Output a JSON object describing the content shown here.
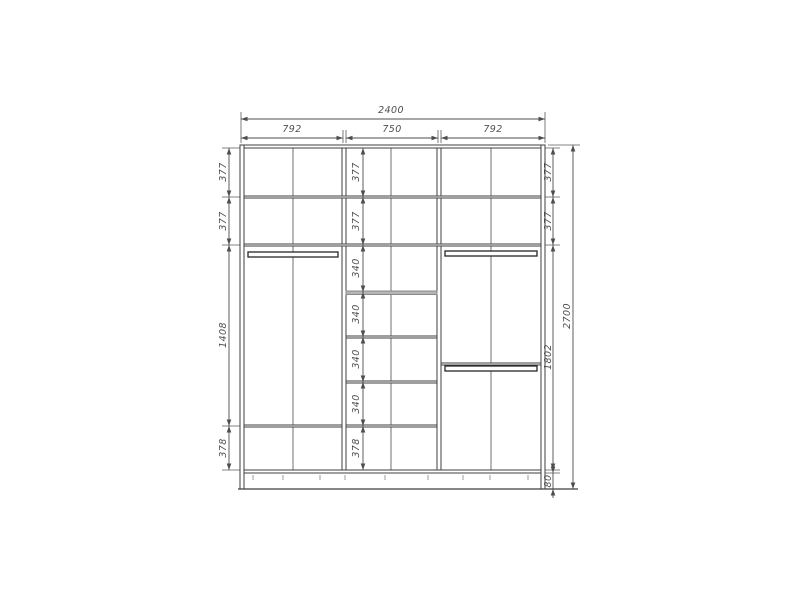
{
  "page": {
    "background": "#ffffff"
  },
  "diagram": {
    "title": "wardrobe-elevation-drawing",
    "canvas": {
      "w": 800,
      "h": 600
    },
    "colors": {
      "line": "#3f3f3f",
      "thin": "#5a5a5a",
      "center": "#6f6f6f",
      "dim": "#4d4d4d",
      "text": "#4f4f4f",
      "gray": "#9c9c9c",
      "rod": "#262626",
      "grayshelf_fill": "#b5b5b5",
      "grayshelf_stroke": "#8a8a8a"
    },
    "panels": [
      {
        "name": "top-panel",
        "x": 240,
        "y": 145,
        "w": 305,
        "h": 3
      },
      {
        "name": "left-side-panel",
        "x": 240,
        "y": 145,
        "w": 4,
        "h": 344
      },
      {
        "name": "right-side-panel",
        "x": 541,
        "y": 145,
        "w": 4,
        "h": 344
      },
      {
        "name": "bottom-panel",
        "x": 244,
        "y": 470,
        "w": 297,
        "h": 3
      },
      {
        "name": "divider-panel",
        "x": 342,
        "y": 148,
        "w": 4,
        "h": 322
      },
      {
        "name": "divider-panel",
        "x": 437,
        "y": 148,
        "w": 4,
        "h": 322
      },
      {
        "name": "shelf-panel",
        "x": 244,
        "y": 196,
        "w": 297,
        "h": 2
      },
      {
        "name": "shelf-panel",
        "x": 244,
        "y": 244,
        "w": 297,
        "h": 2
      },
      {
        "name": "shelf-panel",
        "x": 244,
        "y": 425,
        "w": 98,
        "h": 2
      },
      {
        "name": "shelf-panel-gray",
        "x": 346,
        "y": 291,
        "w": 91,
        "h": 3.5,
        "fill": "#b5b5b5",
        "stroke": "#8a8a8a"
      },
      {
        "name": "shelf-panel",
        "x": 346,
        "y": 336,
        "w": 91,
        "h": 2
      },
      {
        "name": "shelf-panel",
        "x": 346,
        "y": 381,
        "w": 91,
        "h": 2
      },
      {
        "name": "shelf-panel",
        "x": 346,
        "y": 425,
        "w": 91,
        "h": 2
      },
      {
        "name": "shelf-panel",
        "x": 441,
        "y": 363,
        "w": 100,
        "h": 2
      }
    ],
    "rods": [
      {
        "name": "hanger-rod-left",
        "x": 248,
        "y": 252,
        "w": 90,
        "h": 5
      },
      {
        "name": "hanger-rod-right-upper",
        "x": 445,
        "y": 251,
        "w": 92,
        "h": 5
      },
      {
        "name": "hanger-rod-right-lower",
        "x": 445,
        "y": 366,
        "w": 92,
        "h": 5
      }
    ],
    "center_lines": [
      {
        "x1": 293,
        "y1": 148,
        "x2": 293,
        "y2": 470
      },
      {
        "x1": 391,
        "y1": 148,
        "x2": 391,
        "y2": 470
      },
      {
        "x1": 491,
        "y1": 148,
        "x2": 491,
        "y2": 470
      }
    ],
    "floor_line": {
      "x1": 238,
      "y1": 489,
      "x2": 578,
      "y2": 489
    },
    "base_ticks": {
      "y1": 475,
      "y2": 480,
      "xs": [
        253,
        283,
        320,
        345,
        385,
        428,
        463,
        490,
        528
      ]
    },
    "extension_lines": [
      {
        "x1": 241,
        "y1": 143,
        "x2": 241,
        "y2": 112
      },
      {
        "x1": 545,
        "y1": 143,
        "x2": 545,
        "y2": 112
      },
      {
        "x1": 343,
        "y1": 143,
        "x2": 343,
        "y2": 130
      },
      {
        "x1": 346,
        "y1": 143,
        "x2": 346,
        "y2": 130
      },
      {
        "x1": 438,
        "y1": 143,
        "x2": 438,
        "y2": 130
      },
      {
        "x1": 441,
        "y1": 143,
        "x2": 441,
        "y2": 130
      },
      {
        "x1": 222,
        "y1": 148,
        "x2": 240,
        "y2": 148
      },
      {
        "x1": 222,
        "y1": 197,
        "x2": 240,
        "y2": 197
      },
      {
        "x1": 222,
        "y1": 245,
        "x2": 240,
        "y2": 245
      },
      {
        "x1": 222,
        "y1": 426,
        "x2": 240,
        "y2": 426
      },
      {
        "x1": 222,
        "y1": 470,
        "x2": 240,
        "y2": 470
      },
      {
        "x1": 543,
        "y1": 148,
        "x2": 560,
        "y2": 148
      },
      {
        "x1": 543,
        "y1": 197,
        "x2": 560,
        "y2": 197
      },
      {
        "x1": 543,
        "y1": 245,
        "x2": 560,
        "y2": 245
      },
      {
        "x1": 543,
        "y1": 470,
        "x2": 560,
        "y2": 470
      },
      {
        "x1": 543,
        "y1": 473,
        "x2": 560,
        "y2": 473
      },
      {
        "x1": 548,
        "y1": 145,
        "x2": 580,
        "y2": 145
      }
    ],
    "dims_h": [
      {
        "label": "2400",
        "x1": 241,
        "x2": 545,
        "y": 119,
        "tx": 391,
        "ty": 114
      },
      {
        "label": "792",
        "x1": 241,
        "x2": 343,
        "y": 138,
        "tx": 292,
        "ty": 133
      },
      {
        "label": "750",
        "x1": 346,
        "x2": 438,
        "y": 138,
        "tx": 392,
        "ty": 133
      },
      {
        "label": "792",
        "x1": 441,
        "x2": 545,
        "y": 138,
        "tx": 493,
        "ty": 133
      }
    ],
    "dims_v": [
      {
        "label": "377",
        "x": 229,
        "y1": 148,
        "y2": 197,
        "tx": 223,
        "ty": 172
      },
      {
        "label": "377",
        "x": 229,
        "y1": 197,
        "y2": 245,
        "tx": 223,
        "ty": 221
      },
      {
        "label": "1408",
        "x": 229,
        "y1": 245,
        "y2": 426,
        "tx": 223,
        "ty": 335
      },
      {
        "label": "378",
        "x": 229,
        "y1": 426,
        "y2": 470,
        "tx": 223,
        "ty": 448
      },
      {
        "label": "377",
        "x": 363,
        "y1": 148,
        "y2": 197,
        "tx": 356,
        "ty": 172
      },
      {
        "label": "377",
        "x": 363,
        "y1": 197,
        "y2": 245,
        "tx": 356,
        "ty": 221
      },
      {
        "label": "340",
        "x": 363,
        "y1": 245,
        "y2": 292,
        "tx": 356,
        "ty": 268
      },
      {
        "label": "340",
        "x": 363,
        "y1": 292,
        "y2": 337,
        "tx": 356,
        "ty": 314
      },
      {
        "label": "340",
        "x": 363,
        "y1": 337,
        "y2": 382,
        "tx": 356,
        "ty": 359
      },
      {
        "label": "340",
        "x": 363,
        "y1": 382,
        "y2": 426,
        "tx": 356,
        "ty": 404
      },
      {
        "label": "378",
        "x": 363,
        "y1": 426,
        "y2": 470,
        "tx": 356,
        "ty": 448
      },
      {
        "label": "377",
        "x": 553,
        "y1": 148,
        "y2": 197,
        "tx": 548,
        "ty": 172
      },
      {
        "label": "377",
        "x": 553,
        "y1": 197,
        "y2": 245,
        "tx": 548,
        "ty": 221
      },
      {
        "label": "1802",
        "x": 553,
        "y1": 245,
        "y2": 470,
        "tx": 548,
        "ty": 357
      },
      {
        "label": "80",
        "x": 553,
        "y1": 473,
        "y2": 489,
        "tx": 548,
        "ty": 481,
        "outside": true
      },
      {
        "label": "2700",
        "x": 573,
        "y1": 145,
        "y2": 489,
        "tx": 567,
        "ty": 316
      }
    ]
  },
  "dimensions_mm": {
    "overall_width": "2400",
    "overall_height": "2700",
    "top_sections": [
      "792",
      "750",
      "792"
    ],
    "left_column": [
      "377",
      "377",
      "1408",
      "378"
    ],
    "middle_column": [
      "377",
      "377",
      "340",
      "340",
      "340",
      "340",
      "378"
    ],
    "right_column": [
      "377",
      "377",
      "1802",
      "80"
    ]
  }
}
